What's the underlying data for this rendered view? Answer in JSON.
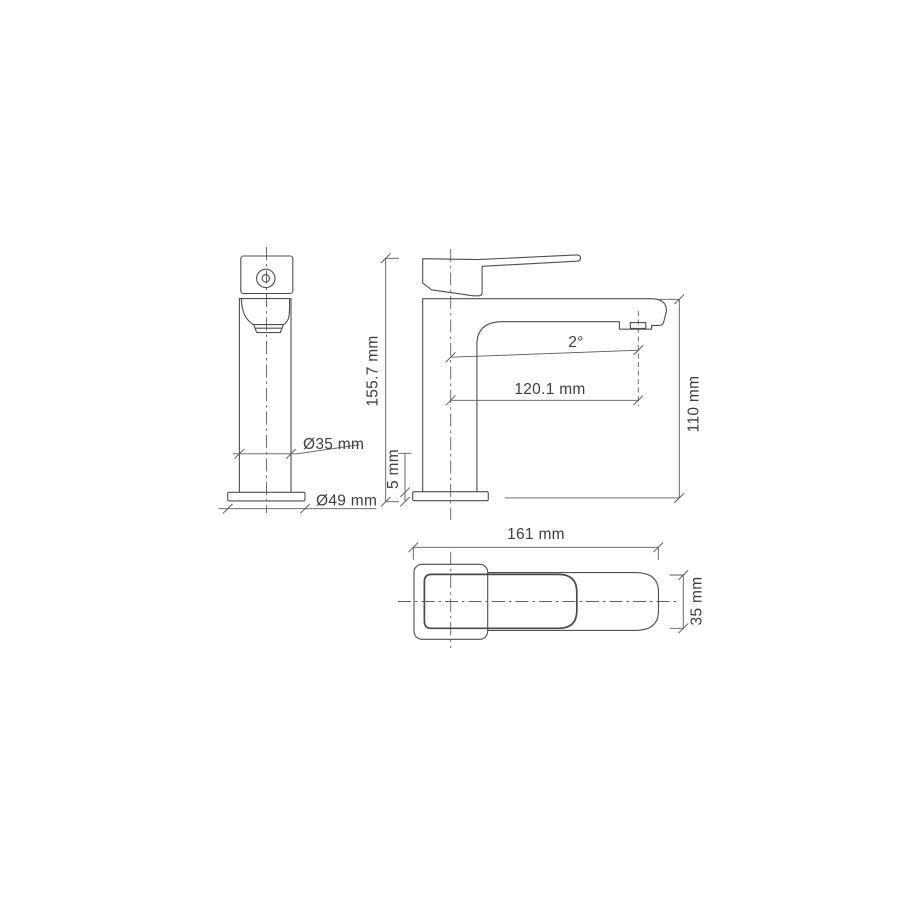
{
  "canvas": {
    "background": "#ffffff",
    "line_color": "#4f4f4f",
    "text_color": "#3e3e3e"
  },
  "views": {
    "front": {
      "body_diameter_label": "Ø35 mm",
      "base_diameter_label": "Ø49 mm"
    },
    "side": {
      "overall_height_label": "155.7 mm",
      "base_plate_label": "5 mm",
      "spout_angle_label": "2°",
      "spout_reach_label": "120.1 mm",
      "outlet_height_label": "110 mm"
    },
    "top": {
      "overall_length_label": "161 mm",
      "body_width_label": "35 mm"
    }
  }
}
